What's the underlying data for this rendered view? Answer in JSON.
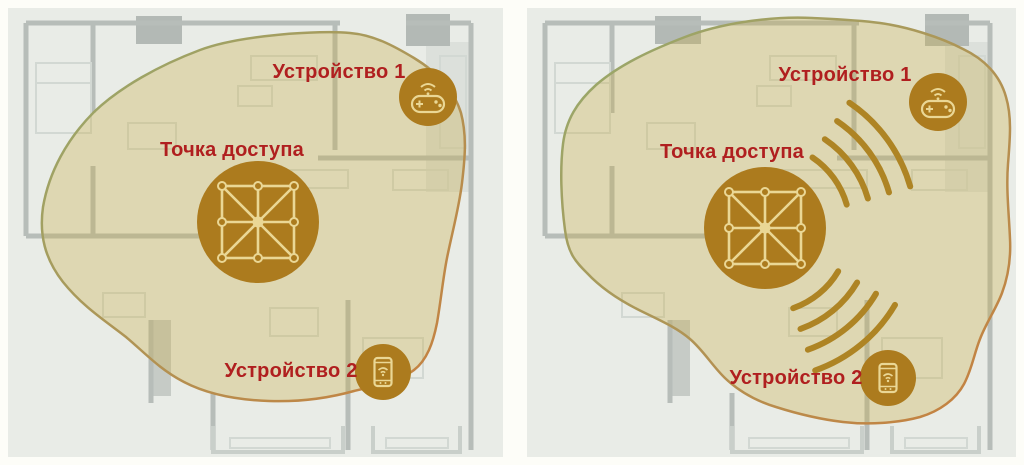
{
  "figure": {
    "title": "Wi-Fi coverage floor-plan comparison",
    "panels": [
      {
        "name": "coverage-without-signal-waves",
        "access_point_label": "Точка доступа",
        "device1_label": "Устройство 1",
        "device2_label": "Устройство 2",
        "signal_waves": false
      },
      {
        "name": "coverage-with-signal-waves",
        "access_point_label": "Точка доступа",
        "device1_label": "Устройство 1",
        "device2_label": "Устройство 2",
        "signal_waves": true
      }
    ],
    "icons": {
      "access_point": "mesh-network-icon",
      "device1": "gamepad-icon",
      "device2": "smartphone-wifi-icon",
      "signal": "wifi-wave-arcs"
    },
    "colors": {
      "label_red": "#b01f1f",
      "node_olive": "#ac7b1e",
      "icon_gold": "#ead795",
      "coverage_fill": "rgba(201,172,70,0.33)",
      "coverage_edge_green": "#95ab6e",
      "coverage_edge_orange": "#c87f3e",
      "wave_gold": "#ae8424",
      "panel_background": "#e9ece7",
      "page_background": "#fdfdf8"
    }
  }
}
